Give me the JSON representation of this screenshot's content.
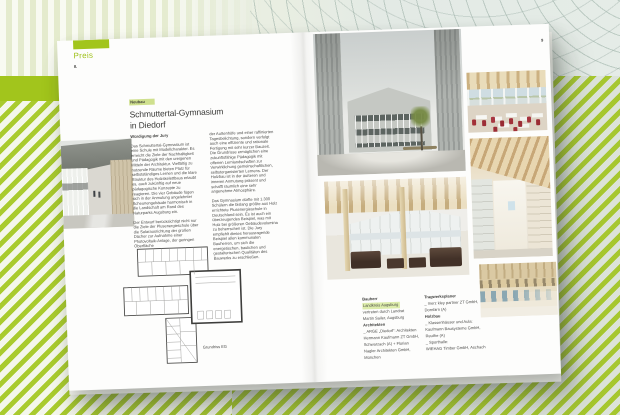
{
  "colors": {
    "accent_green": "#a2c51c",
    "label_highlight": "#cfe08e",
    "credit_highlight": "#dcecaa"
  },
  "left_page": {
    "tab_label": "Preis",
    "page_number": "8.",
    "category_label": "Neubau",
    "title_line1": "Schmuttertal-Gymnasium",
    "title_line2": "in Diedorf",
    "jury_heading": "Würdigung der Jury",
    "col1_p1": "Das Schmuttertal-Gymnasium ist eine Schule mit Modellcharakter. Es erreicht die Ziele der Nachhaltigkeit und Pädagogik mit den ureigenen Mitteln der Architektur. Vielfältig zu nutzende Räume bieten Platz für selbstständiges Lernen und die klare Struktur des Holzskelettbaus erlaubt es, auch zukünftig auf neue pädagogische Konzepte zu reagieren. Die vier Gebäude fügen sich in der Anmutung angelehnter Scheunengebäude harmonisch in die Landschaft am Rand des Naturparks Augsburg ein.",
    "col1_p2": "Der Entwurf berücksichtigt nicht nur die Ziele der Plusenergieschule über die Solarausrichtung der großen Dächer zur Aufnahme einer Photovoltaik-Anlage, der geringen Oberfläche",
    "col2_p1": "der Außenhöfe und einer raffinierten Tagesbelichtung, sondern verfolgt auch eine effiziente und rationale Fertigung mit sehr kurzer Bauzeit. Die Grundrisse ermöglichen eine zukunftsfähige Pädagogik mit offenen Lernlandschaften zur Verwirklichung gemeinschaftlichen, selbstorganisierten Lernens. Der Holzbau ist in der äußeren und inneren Anmutung präsent und schafft räumlich eine sehr angenehme Atmosphäre.",
    "col2_p2": "Das Gymnasium dürfte mit 1.300 Schülern die bislang größte aus Holz errichtete Plusenergieschule in Deutschland sein. Es ist auch ein überzeugendes Beispiel, was mit Holz bei größeren Gebäudevolumina zu beherrschen ist. Die Jury empfiehlt dieses herausragende Beispiel allen kommunalen Bauherren, um sich die energetischen, baulichen und gestalterischen Qualitäten des Bauwerks zu erschließen.",
    "plan_caption": "Grundriss EG",
    "photo": "covered-walkway-exterior"
  },
  "right_page": {
    "page_number": "9",
    "photos": {
      "large": "courtyard-between-timber-clad-buildings",
      "top_right": "classroom-with-red-chairs",
      "mid_right": "timber-roof-corridor",
      "mid_left": "atrium-lounge-with-brown-sofas",
      "bottom_right": "sports-hall-interior"
    },
    "credits": {
      "col1": [
        "Bauherr",
        "Landkreis Augsburg",
        "vertreten durch Landrat",
        "Martin Sailer, Augsburg",
        "Architekten",
        "_ ARGE „Diedorf“: Architekten",
        "Hermann Kaufmann ZT GmbH,",
        "Schwarzach (A) + Florian",
        "Nagler Architekten GmbH,",
        "München"
      ],
      "col2": [
        "Tragwerksplaner",
        "_ merz kley partner ZT GmbH,",
        "Dornbirn (A)",
        "Holzbau",
        "_ Klassenhäuser und Aula:",
        "Kaufmann Bausysteme GmbH,",
        "Reuthe (A)",
        "_ Sporthalle:",
        "WIEHAG Timber GmbH, Aschach"
      ]
    }
  }
}
